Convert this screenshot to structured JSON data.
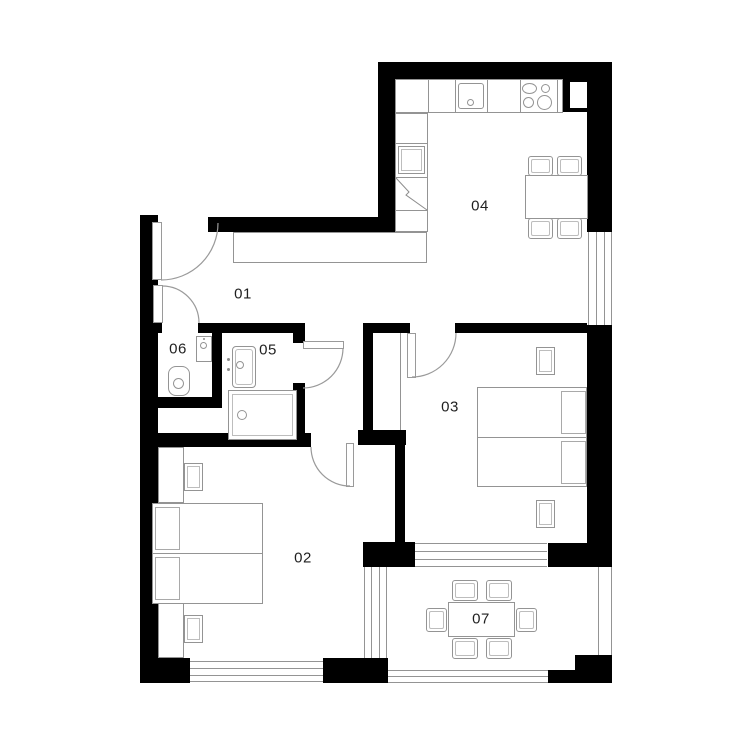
{
  "page": {
    "background": "#ffffff"
  },
  "colors": {
    "wall": "#000000",
    "furniture_line": "#949494",
    "door_arc": "#9a9a9a",
    "label_text": "#1f1f1f"
  },
  "rooms": [
    {
      "label": "01",
      "icons": [
        "entrance-door",
        "wardrobe"
      ]
    },
    {
      "label": "02",
      "icons": [
        "double-bed",
        "pillow",
        "pillow",
        "nightstand",
        "nightstand",
        "closet",
        "closet",
        "window",
        "door"
      ]
    },
    {
      "label": "03",
      "icons": [
        "double-bed",
        "pillow",
        "pillow",
        "nightstand",
        "nightstand",
        "door",
        "window-to-terrace"
      ]
    },
    {
      "label": "04",
      "icons": [
        "kitchen-counter",
        "kitchen-sink",
        "cooktop-4-burners",
        "fridge",
        "tall-unit",
        "dining-table",
        "chair",
        "chair",
        "chair",
        "chair",
        "window"
      ]
    },
    {
      "label": "05",
      "icons": [
        "washbasin",
        "shower",
        "door"
      ]
    },
    {
      "label": "06",
      "icons": [
        "hand-sink",
        "toilet",
        "door"
      ]
    },
    {
      "label": "07",
      "icons": [
        "outdoor-table",
        "chair",
        "chair",
        "chair",
        "chair",
        "chair",
        "chair",
        "railing"
      ]
    }
  ]
}
